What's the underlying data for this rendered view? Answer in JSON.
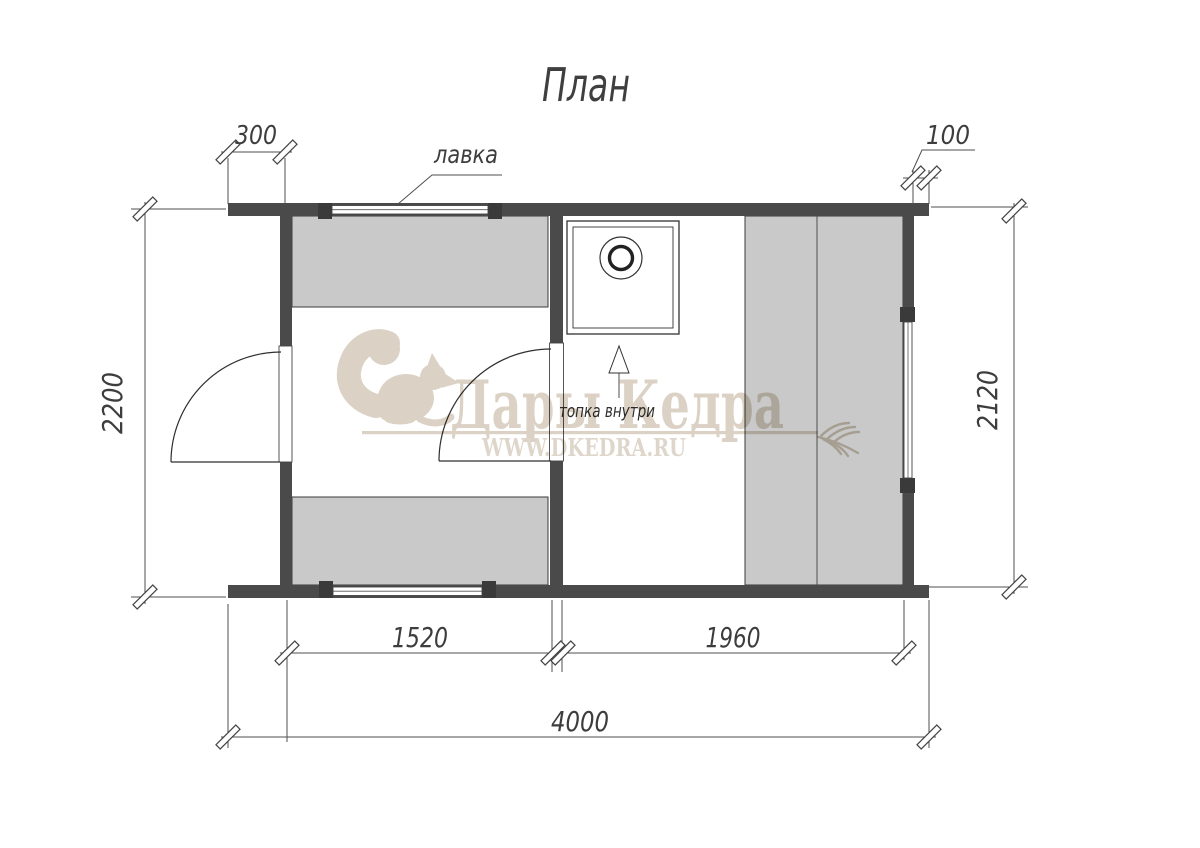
{
  "title": "План",
  "labels": {
    "bench": "лавка",
    "stove_note": "топка внутри"
  },
  "dimensions": {
    "overhang_left": "300",
    "overhang_right": "100",
    "depth_left": "2200",
    "depth_right": "2120",
    "room_steam_length": "1520",
    "room_rest_length": "1960",
    "total_length": "4000"
  },
  "watermark": {
    "brand": "Дары Кедра",
    "website": "WWW.DKEDRA.RU"
  },
  "colors": {
    "wall": "#4a4a4a",
    "bench_fill": "#c9c9c9",
    "line": "#4f4f4f",
    "text": "#3d3d3d",
    "watermark": "#d9cfc1",
    "background": "#ffffff"
  }
}
